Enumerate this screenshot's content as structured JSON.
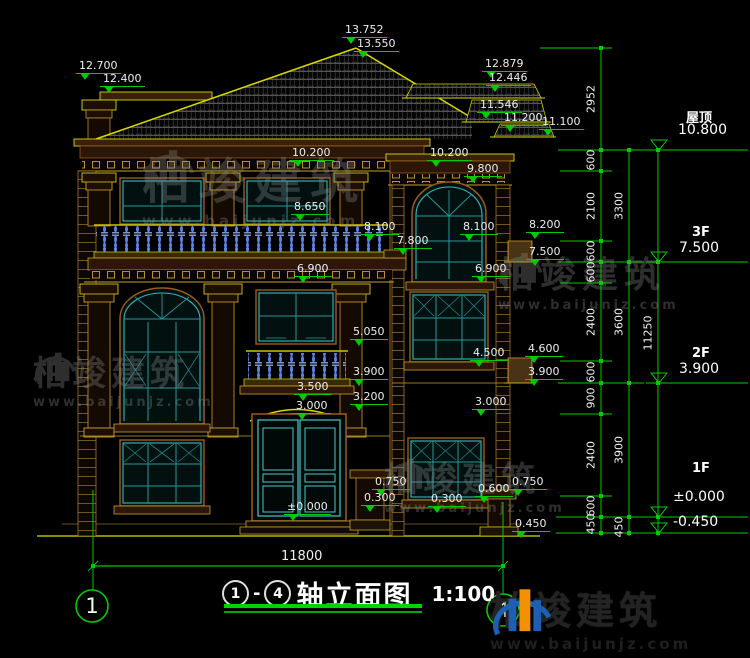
{
  "drawing": {
    "axis_start": "1",
    "separator": "-",
    "axis_end": "4",
    "title": "轴立面图",
    "scale": "1:100",
    "overall_width": "11800"
  },
  "axes": {
    "left": "1",
    "right": "4"
  },
  "levels": {
    "roof": {
      "label": "屋顶",
      "value": "10.800"
    },
    "f3": {
      "label": "3F",
      "value": "7.500"
    },
    "f2": {
      "label": "2F",
      "value": "3.900"
    },
    "f1": {
      "label": "1F",
      "value": "±0.000",
      "below": "-0.450"
    }
  },
  "elevation_markers": [
    "13.752",
    "13.550",
    "12.700",
    "12.400",
    "12.879",
    "12.446",
    "11.546",
    "11.200",
    "11.100",
    "10.200",
    "10.200",
    "9.800",
    "8.650",
    "8.100",
    "8.100",
    "8.200",
    "7.800",
    "7.500",
    "6.900",
    "6.900",
    "5.050",
    "4.500",
    "4.600",
    "3.900",
    "3.900",
    "3.500",
    "3.200",
    "3.000",
    "3.000",
    "0.750",
    "0.300",
    "0.300",
    "0.600",
    "0.750",
    "0.450",
    "±0.000"
  ],
  "dim_inner": [
    "2952",
    "600",
    "2100",
    "600",
    "600",
    "2400",
    "600",
    "900",
    "2400",
    "600",
    "450"
  ],
  "dim_mid": [
    "3300",
    "3600",
    "3900",
    "450"
  ],
  "dim_outer": [
    "11250"
  ],
  "watermark": {
    "brand": "柏竣建筑",
    "website": "www.baijunjz.com"
  },
  "logo": {
    "brand": "柏竣建筑",
    "website": "www.baijunjz.com"
  }
}
